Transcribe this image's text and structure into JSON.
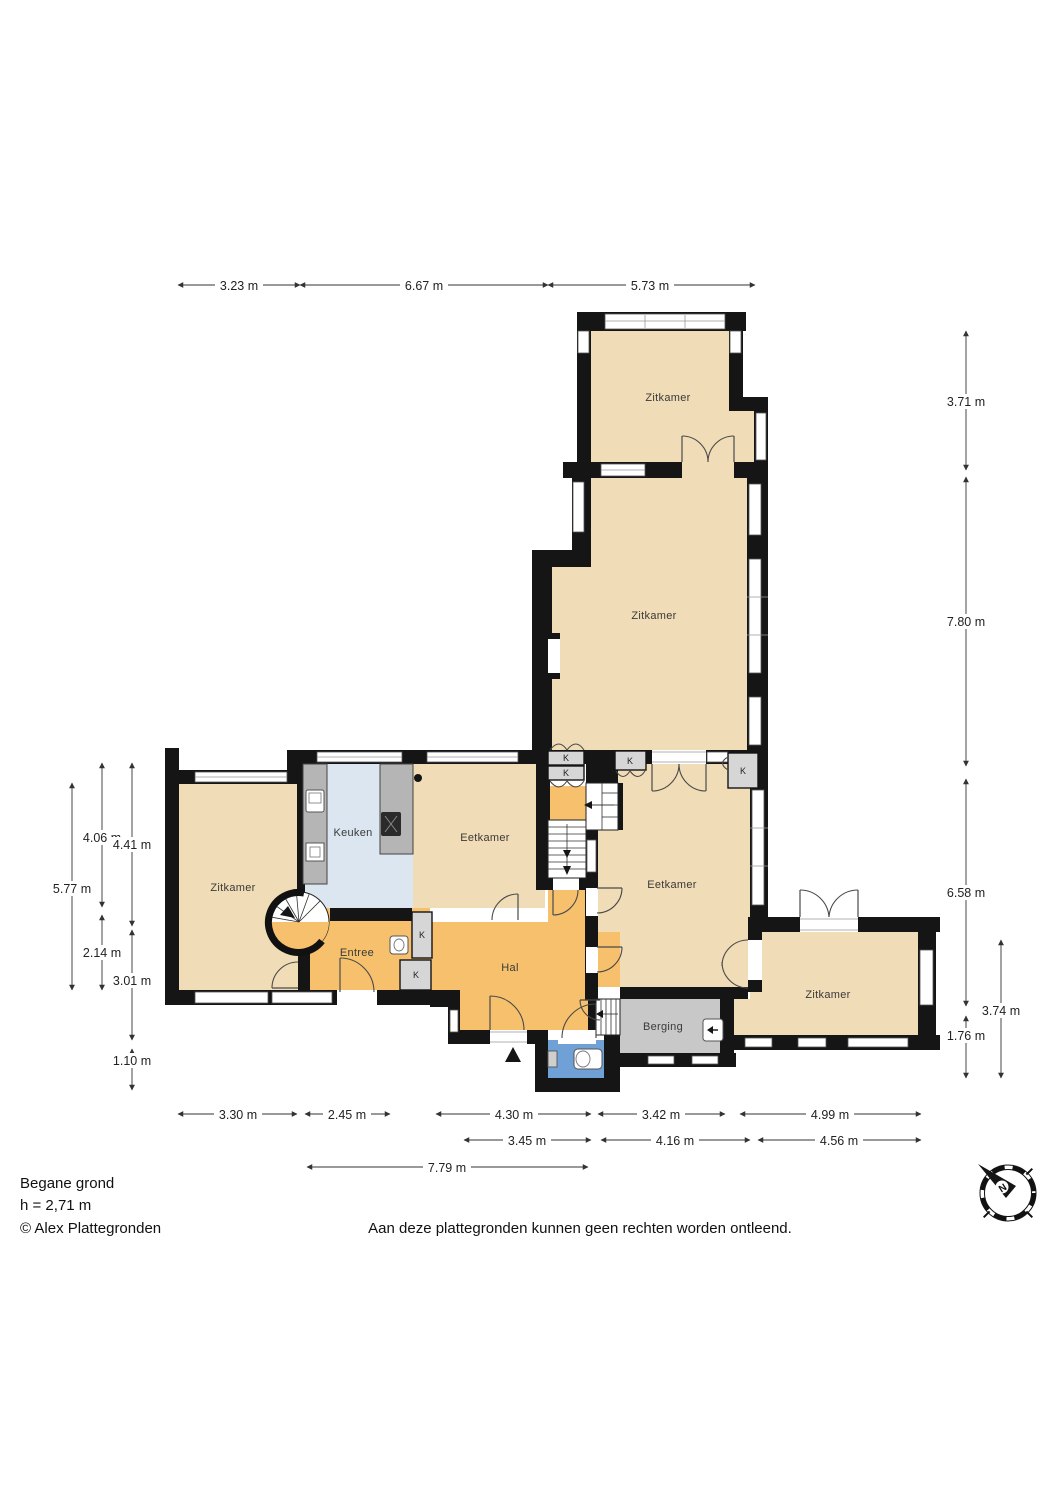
{
  "plan": {
    "floor_title": "Begane grond",
    "floor_height": "h = 2,71 m",
    "copyright": "© Alex Plattegronden",
    "disclaimer": "Aan deze plattegronden kunnen geen rechten worden ontleend.",
    "compass_letter": "N"
  },
  "rooms": [
    {
      "id": "zitkamer-top",
      "label": "Zitkamer"
    },
    {
      "id": "zitkamer-mid",
      "label": "Zitkamer"
    },
    {
      "id": "zitkamer-left",
      "label": "Zitkamer"
    },
    {
      "id": "keuken",
      "label": "Keuken"
    },
    {
      "id": "eetkamer-left",
      "label": "Eetkamer"
    },
    {
      "id": "eetkamer-right",
      "label": "Eetkamer"
    },
    {
      "id": "entree",
      "label": "Entree"
    },
    {
      "id": "hal",
      "label": "Hal"
    },
    {
      "id": "berging",
      "label": "Berging"
    },
    {
      "id": "zitkamer-bottom",
      "label": "Zitkamer"
    }
  ],
  "closets": [
    "K",
    "K",
    "K",
    "K",
    "K",
    "K"
  ],
  "dimensions": {
    "top": [
      "3.23 m",
      "6.67 m",
      "5.73 m"
    ],
    "right": [
      "3.71 m",
      "7.80 m",
      "6.58 m",
      "1.76 m",
      "3.74 m"
    ],
    "left": [
      "4.06 m",
      "4.41 m",
      "5.77 m",
      "2.14 m",
      "3.01 m",
      "1.10 m"
    ],
    "bottom_row1": [
      "3.30 m",
      "2.45 m",
      "4.30 m",
      "3.42 m",
      "4.99 m"
    ],
    "bottom_row2": [
      "3.45 m",
      "4.16 m",
      "4.56 m"
    ],
    "bottom_row3": [
      "7.79 m"
    ]
  },
  "colors": {
    "room_beige": "#f0dcb6",
    "room_orange": "#f6c06d",
    "kitchen_blue": "#dbe6f0",
    "wc_blue": "#6fa0d6",
    "storage_gray": "#c8c8c8",
    "wall_black": "#151515"
  }
}
